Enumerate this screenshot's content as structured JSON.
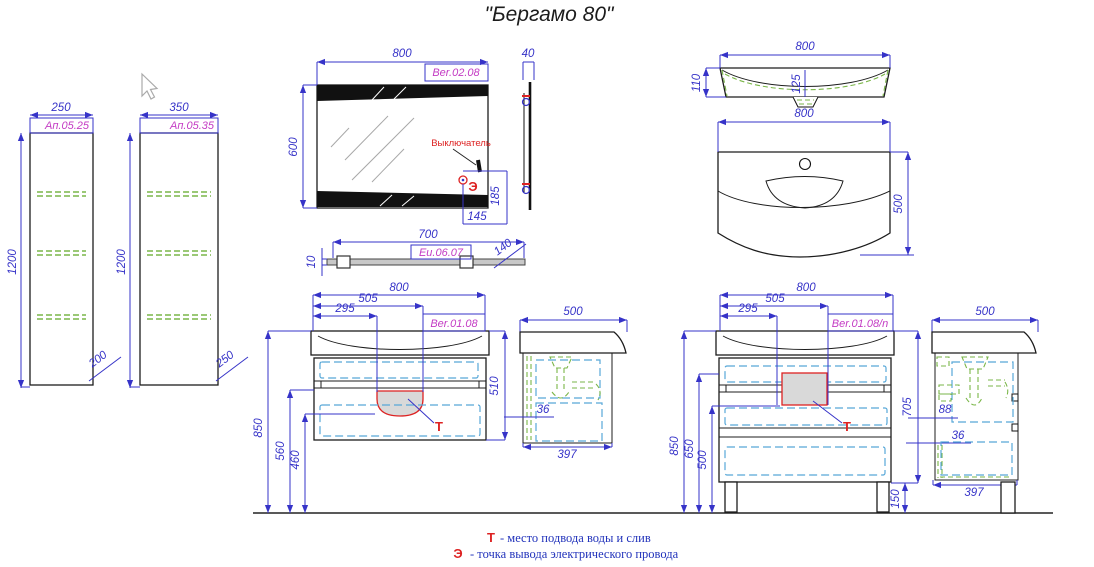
{
  "title": "\"Бергамо 80\"",
  "colors": {
    "dimension_blue": "#3633c8",
    "label_magenta": "#c43cc4",
    "accent_red": "#dd2222",
    "shelf_green": "#7ab648",
    "drawer_cyan": "#58a8d8",
    "legend_blue": "#2233bb"
  },
  "cabinet_small": {
    "width": "250",
    "label": "Ап.05.25",
    "height": "1200",
    "depth": "200"
  },
  "cabinet_large": {
    "width": "350",
    "label": "Ап.05.35",
    "height": "1200",
    "depth": "250"
  },
  "mirror": {
    "width": "800",
    "label": "Ber.02.08",
    "height": "600",
    "depth": "40",
    "switch": "Выключатель",
    "electric": "Э",
    "offset_x": "145",
    "offset_y": "185"
  },
  "shelf": {
    "length": "700",
    "label": "Eu.06.07",
    "thickness": "10",
    "depth": "140"
  },
  "sink": {
    "width": "800",
    "profile_height": "110",
    "basin_depth": "125",
    "plan_width": "800",
    "plan_depth": "500"
  },
  "vanity_wall": {
    "label": "Ber.01.08",
    "width": "800",
    "dim_505": "505",
    "dim_295": "295",
    "height": "510",
    "mount_height": "850",
    "dim_560": "560",
    "dim_460": "460",
    "t": "Т",
    "side": {
      "width": "500",
      "gap": "36",
      "depth": "397"
    }
  },
  "vanity_floor": {
    "label": "Ber.01.08/n",
    "width": "800",
    "dim_505": "505",
    "dim_295": "295",
    "height": "705",
    "total_height": "850",
    "dim_650": "650",
    "dim_500": "500",
    "leg_height": "150",
    "t": "Т",
    "side": {
      "width": "500",
      "dim_88": "88",
      "gap": "36",
      "depth": "397"
    }
  },
  "legend": {
    "t_symbol": "Т",
    "t_text": "-  место подвода воды и слив",
    "e_symbol": "Э",
    "e_text": "-  точка вывода электрического провода"
  }
}
